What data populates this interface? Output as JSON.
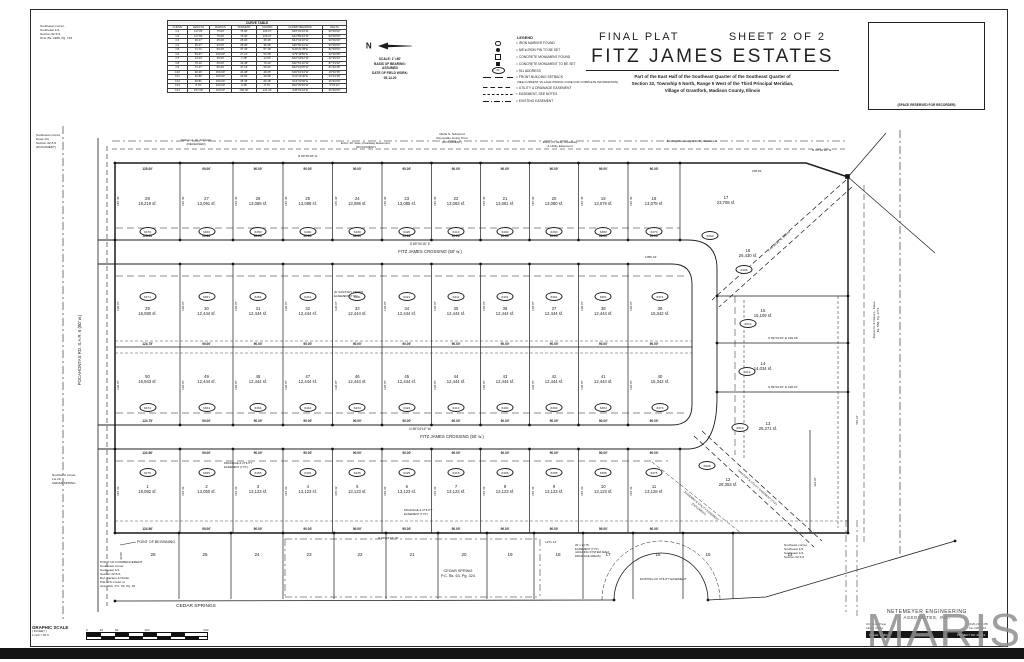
{
  "sheet": {
    "final_plat": "FINAL PLAT",
    "sheet_no": "SHEET 2 OF 2",
    "title": "FITZ JAMES ESTATES",
    "description": [
      "Part of the East Half of the Southeast Quarter of the Southeast Quarter of",
      "Section 32, Township 5 North, Range 5 West of the Third Principal Meridian,",
      "Village of Grantfork, Madison County, Illinois"
    ],
    "recorder_box": "(SPACE RESERVED FOR RECORDER)"
  },
  "north_block": {
    "north": "N",
    "lines": [
      "SCALE: 1\"=60'",
      "BASIS OF BEARING:",
      "ASSUMED",
      "DATE OF FIELD WORK:",
      "05-14-20"
    ]
  },
  "curve_table": {
    "title": "CURVE TABLE",
    "columns": [
      "CURVE",
      "LENGTH",
      "RADIUS",
      "TANGENT",
      "CHORD",
      "CHORD BEARING",
      "DELTA"
    ],
    "rows": [
      [
        "C1",
        "117.81'",
        "75.00'",
        "75.00'",
        "106.07'",
        "N45°04'16\"W",
        "90°00'00\""
      ],
      [
        "C2",
        "117.81'",
        "75.00'",
        "75.00'",
        "106.07'",
        "S44°55'44\"W",
        "90°00'00\""
      ],
      [
        "C3",
        "39.27'",
        "25.00'",
        "25.00'",
        "35.36'",
        "N44°04'16\"W",
        "90°00'00\""
      ],
      [
        "C4",
        "39.27'",
        "25.00'",
        "25.00'",
        "35.36'",
        "S45°55'44\"W",
        "90°00'00\""
      ],
      [
        "C5",
        "71.71'",
        "50.00'",
        "37.43'",
        "67.18'",
        "N40°21'35\"E",
        "82°09'54\""
      ],
      [
        "C6",
        "53.67'",
        "150.00'",
        "27.21'",
        "53.38'",
        "S79°48'50\"E",
        "20°30'08\""
      ],
      [
        "C7",
        "14.23'",
        "25.00'",
        "7.28'",
        "14.04'",
        "N16°34'52\"W",
        "32°36'24\""
      ],
      [
        "C8",
        "76.12'",
        "50.00'",
        "44.38'",
        "70.42'",
        "S02°51'10\"W",
        "87°13'32\""
      ],
      [
        "C9",
        "71.27'",
        "50.00'",
        "37.13'",
        "66.93'",
        "N42°10'05\"W",
        "81°40'28\""
      ],
      [
        "C10",
        "48.46'",
        "150.00'",
        "24.48'",
        "48.25'",
        "S09°16'44\"W",
        "18°30'35\""
      ],
      [
        "C11",
        "40.86'",
        "100.00'",
        "20.82'",
        "40.58'",
        "N11°44'40\"E",
        "23°24'48\""
      ],
      [
        "C12",
        "69.81'",
        "150.00'",
        "35.45'",
        "69.18'",
        "S13°20'00\"E",
        "26°40'00\""
      ],
      [
        "C13",
        "8.76'",
        "100.00'",
        "4.38'",
        "8.76'",
        "N02°30'36\"W",
        "5°01'12\""
      ],
      [
        "C14",
        "157.08'",
        "100.00'",
        "100.00'",
        "141.42'",
        "S45°04'16\"E",
        "90°00'00\""
      ]
    ]
  },
  "legend": {
    "title": "LEGEND",
    "items": [
      {
        "sym": "circle-open",
        "label": "= IRON MARKER FOUND"
      },
      {
        "sym": "circle-filled",
        "label": "= 5/8\"ø IRON PIN TO BE SET"
      },
      {
        "sym": "square-open",
        "label": "= CONCRETE MONUMENT FOUND"
      },
      {
        "sym": "square-filled",
        "label": "= CONCRETE MONUMENT TO BE SET"
      },
      {
        "sym": "oval",
        "label": "= 911 ADDRESS"
      },
      {
        "sym": "line-longdash",
        "label": "= FRONT BUILDING SETBACK"
      },
      {
        "sym": "note",
        "label": "(SEE CURRENT VILLAGE ZONING CODE FOR COMPLETE INFORMATION)"
      },
      {
        "sym": "line-dash",
        "label": "= UTILITY & DRAINAGE EASEMENT"
      },
      {
        "sym": "line-shortdash",
        "label": "= EASEMENT, SEE NOTES"
      },
      {
        "sym": "line-dashdot",
        "label": "= EXISTING EASEMENT"
      }
    ]
  },
  "plat": {
    "streets": {
      "fitz_james_1": "FITZ JAMES CROSSING (50' w.)",
      "fitz_james_2": "FITZ JAMES CROSSING (50' w.)",
      "pocahontas": "POCAHONTAS RD.   S.A.R. 6   (80' w.)",
      "cedar_springs": "CEDAR SPRINGS",
      "cedar_spring_plat": [
        "CEDAR SPRING",
        "P.C. Bk. 63, Pg. 324"
      ]
    },
    "rows": {
      "top": [
        {
          "num": "28",
          "area": "18,219 sf.",
          "addr": "6470"
        },
        {
          "num": "27",
          "area": "13,091 sf.",
          "addr": "6460"
        },
        {
          "num": "26",
          "area": "13,089 sf.",
          "addr": "6450"
        },
        {
          "num": "25",
          "area": "13,088 sf.",
          "addr": "6440"
        },
        {
          "num": "24",
          "area": "13,086 sf.",
          "addr": "6430"
        },
        {
          "num": "23",
          "area": "13,085 sf.",
          "addr": "6420"
        },
        {
          "num": "22",
          "area": "13,083 sf.",
          "addr": "6410"
        },
        {
          "num": "21",
          "area": "13,081 sf.",
          "addr": "6400"
        },
        {
          "num": "20",
          "area": "13,080 sf.",
          "addr": "6390"
        },
        {
          "num": "19",
          "area": "13,079 sf.",
          "addr": "6380"
        },
        {
          "num": "18",
          "area": "13,078 sf.",
          "addr": "6370"
        }
      ],
      "mid_upper": [
        {
          "num": "29",
          "area": "16,080 sf.",
          "addr": "6471"
        },
        {
          "num": "30",
          "area": "12,444 sf.",
          "addr": "6461"
        },
        {
          "num": "31",
          "area": "12,444 sf.",
          "addr": "6451"
        },
        {
          "num": "32",
          "area": "12,444 sf.",
          "addr": "6441"
        },
        {
          "num": "33",
          "area": "12,444 sf.",
          "addr": "6431"
        },
        {
          "num": "34",
          "area": "12,444 sf.",
          "addr": "6421"
        },
        {
          "num": "35",
          "area": "12,444 sf.",
          "addr": "6411"
        },
        {
          "num": "36",
          "area": "12,444 sf.",
          "addr": "6401"
        },
        {
          "num": "37",
          "area": "12,444 sf.",
          "addr": "6391"
        },
        {
          "num": "38",
          "area": "12,444 sf.",
          "addr": "6381"
        },
        {
          "num": "39",
          "area": "15,342 sf.",
          "addr": "6371"
        }
      ],
      "mid_lower": [
        {
          "num": "50",
          "area": "16,943 sf.",
          "addr": "6474"
        },
        {
          "num": "49",
          "area": "12,444 sf.",
          "addr": "6464"
        },
        {
          "num": "48",
          "area": "12,444 sf.",
          "addr": "6454"
        },
        {
          "num": "47",
          "area": "12,444 sf.",
          "addr": "6444"
        },
        {
          "num": "46",
          "area": "12,444 sf.",
          "addr": "6434"
        },
        {
          "num": "45",
          "area": "12,444 sf.",
          "addr": "6424"
        },
        {
          "num": "44",
          "area": "12,444 sf.",
          "addr": "6414"
        },
        {
          "num": "43",
          "area": "12,444 sf.",
          "addr": "6404"
        },
        {
          "num": "42",
          "area": "12,444 sf.",
          "addr": "6394"
        },
        {
          "num": "41",
          "area": "12,444 sf.",
          "addr": "6384"
        },
        {
          "num": "40",
          "area": "15,342 sf.",
          "addr": "6374"
        }
      ],
      "bottom": [
        {
          "num": "1",
          "area": "18,082 sf.",
          "addr": "6475"
        },
        {
          "num": "2",
          "area": "13,050 sf.",
          "addr": "6465"
        },
        {
          "num": "3",
          "area": "13,123 sf.",
          "addr": "6455"
        },
        {
          "num": "4",
          "area": "13,123 sf.",
          "addr": "6445"
        },
        {
          "num": "5",
          "area": "13,123 sf.",
          "addr": "6435"
        },
        {
          "num": "6",
          "area": "13,123 sf.",
          "addr": "6425"
        },
        {
          "num": "7",
          "area": "13,123 sf.",
          "addr": "6415"
        },
        {
          "num": "8",
          "area": "13,123 sf.",
          "addr": "6405"
        },
        {
          "num": "9",
          "area": "13,123 sf.",
          "addr": "6395"
        },
        {
          "num": "10",
          "area": "13,123 sf.",
          "addr": "6385"
        },
        {
          "num": "11",
          "area": "13,128 sf.",
          "addr": "6375"
        }
      ],
      "east": [
        {
          "num": "17",
          "area": "23,708 sf.",
          "addr": "6360"
        },
        {
          "num": "16",
          "area": "26,430 sf.",
          "addr": "6406"
        },
        {
          "num": "15",
          "area": "15,109 sf.",
          "addr": "6614"
        },
        {
          "num": "14",
          "area": "14,034 sf.",
          "addr": "6612"
        },
        {
          "num": "13",
          "area": "25,271 sf.",
          "addr": "6610"
        },
        {
          "num": "12",
          "area": "28,353 sf.",
          "addr": "6608"
        }
      ],
      "south_strip": [
        "26",
        "25",
        "24",
        "23",
        "22",
        "21",
        "20",
        "19",
        "18",
        "17",
        "16",
        "15",
        "14"
      ]
    },
    "dims": [
      {
        "y": 167,
        "labels": [
          "125.00'",
          "90.00'",
          "90.00'",
          "90.00'",
          "90.00'",
          "90.00'",
          "90.00'",
          "90.00'",
          "90.00'",
          "90.00'",
          "90.00'"
        ]
      },
      {
        "y": 234,
        "labels": [
          "125.00'",
          "90.00'",
          "90.00'",
          "90.00'",
          "90.00'",
          "90.00'",
          "90.00'",
          "90.00'",
          "90.00'",
          "90.00'",
          "90.00'"
        ]
      },
      {
        "y": 342,
        "labels": [
          "124.75'",
          "90.00'",
          "90.00'",
          "90.00'",
          "90.00'",
          "90.00'",
          "90.00'",
          "90.00'",
          "90.00'",
          "90.00'",
          "90.00'"
        ]
      },
      {
        "y": 419,
        "labels": [
          "124.75'",
          "90.00'",
          "90.00'",
          "90.00'",
          "90.00'",
          "90.00'",
          "90.00'",
          "90.00'",
          "90.00'",
          "90.00'",
          "90.00'"
        ]
      },
      {
        "y": 451,
        "labels": [
          "124.96'",
          "90.00'",
          "90.00'",
          "90.00'",
          "90.00'",
          "90.00'",
          "90.00'",
          "90.00'",
          "90.00'",
          "90.00'",
          "90.00'"
        ]
      },
      {
        "y": 527,
        "labels": [
          "124.96'",
          "90.00'",
          "90.00'",
          "90.00'",
          "90.00'",
          "90.00'",
          "90.00'",
          "90.00'",
          "90.00'",
          "90.00'",
          "90.00'"
        ]
      }
    ],
    "side_dims": {
      "top": "145.40'",
      "mid_upper": "138.07'",
      "mid_lower": "138.07'",
      "bottom": "145.43'"
    },
    "annotations": [
      {
        "x": 40,
        "y": 24,
        "fs": 3.1,
        "lines": [
          "Southwest corner,",
          "Southeast 1/4,",
          "Section 32-5-5,",
          "W.R. Bk. 2486, Pg. 743"
        ]
      },
      {
        "x": 36,
        "y": 133,
        "fs": 3.1,
        "lines": [
          "Southwest corner,",
          "Deed 1/4,",
          "Section 32-5-5",
          "(DOCUMENT)"
        ]
      },
      {
        "x": 52,
        "y": 473,
        "fs": 3.1,
        "lines": [
          "Northwest corner,",
          "Lot 26,",
          "CEDAR SPRING"
        ]
      },
      {
        "x": 137,
        "y": 540,
        "fs": 3.6,
        "lines": [
          "POINT OF BEGINNING"
        ]
      },
      {
        "x": 100,
        "y": 560,
        "fs": 3.1,
        "lines": [
          "POINT OF COMMENCEMENT",
          "Southeast corner,",
          "Southeast 1/4,",
          "Section 32-5-5,",
          "Ref. Backes & Pfeifer",
          "Plat of D-J Add. to",
          "Grantfork, P.C. 52, Pg. 46"
        ]
      },
      {
        "x": 784,
        "y": 543,
        "fs": 3.1,
        "lines": [
          "Northeast corner,",
          "Southeast 1/4,",
          "Southeast 1/4,",
          "Section 32-5-5"
        ]
      },
      {
        "x": 196,
        "y": 138,
        "fs": 3.1,
        "al": "c",
        "lines": [
          "Nathan A. W. Schwarz",
          "(DECEASED)"
        ]
      },
      {
        "x": 366,
        "y": 141,
        "fs": 3.1,
        "al": "c",
        "lines": [
          "Exist. 20' wide, Roadway Easement,",
          "(DOCUMENT)"
        ]
      },
      {
        "x": 452,
        "y": 132,
        "fs": 3.1,
        "al": "c",
        "lines": [
          "Marla S. Schwend",
          "Revocable Living Trust",
          "(DOCUMENT)"
        ]
      },
      {
        "x": 560,
        "y": 140,
        "fs": 3.1,
        "al": "c",
        "lines": [
          "Exist. 20' wide, Roadway",
          "& Utility Easement"
        ]
      },
      {
        "x": 692,
        "y": 139,
        "fs": 3.1,
        "al": "c",
        "lines": [
          "Existing Roadway & Utility Easement"
        ]
      },
      {
        "x": 812,
        "y": 148,
        "fs": 3.1,
        "lines": [
          "N 00°40'26\" E"
        ]
      },
      {
        "x": 876,
        "y": 320,
        "fs": 3.1,
        "rot": -90,
        "al": "c",
        "lines": [
          "James R. & Diane L. Klaus",
          "Bk. 558, Pg. 1774"
        ]
      },
      {
        "x": 420,
        "y": 242,
        "fs": 3.3,
        "al": "c",
        "lines": [
          "S 89°04'16\" E"
        ]
      },
      {
        "x": 645,
        "y": 255,
        "fs": 3.1,
        "lines": [
          "1055.34'"
        ]
      },
      {
        "x": 420,
        "y": 427,
        "fs": 3.3,
        "al": "c",
        "lines": [
          "N 89°04'16\" W"
        ]
      },
      {
        "x": 298,
        "y": 154,
        "fs": 3.1,
        "lines": [
          "N 89°40'26\" E"
        ]
      },
      {
        "x": 752,
        "y": 169,
        "fs": 3.1,
        "lines": [
          "236.81'"
        ]
      },
      {
        "x": 779,
        "y": 241,
        "fs": 3.1,
        "rot": -42,
        "al": "c",
        "lines": [
          "S 46°23'51\" E   340.44'"
        ]
      },
      {
        "x": 783,
        "y": 336,
        "fs": 3.1,
        "al": "c",
        "lines": [
          "S 89°04'16\" E   199.96'"
        ]
      },
      {
        "x": 783,
        "y": 385,
        "fs": 3.1,
        "al": "c",
        "lines": [
          "S 89°04'16\" E   196.97'"
        ]
      },
      {
        "x": 378,
        "y": 536,
        "fs": 3.1,
        "lines": [
          "N 89°04'16\" W"
        ]
      },
      {
        "x": 545,
        "y": 540,
        "fs": 3.1,
        "lines": [
          "1271.14'"
        ]
      },
      {
        "x": 575,
        "y": 544,
        "fs": 2.8,
        "lines": [
          "20' x 24.75'",
          "EASEMENT (TYP.)",
          "(HOLDING SYSTEM AREA",
          "DRAINAGE AREAS)"
        ]
      },
      {
        "x": 640,
        "y": 578,
        "fs": 2.9,
        "lines": [
          "EXISTING 20' UTILITY EASEMENT"
        ]
      },
      {
        "x": 757,
        "y": 488,
        "fs": 2.8,
        "rot": 42,
        "al": "c",
        "lines": [
          "SANITARY & UTILITY EASEMENT (TYP.)"
        ]
      },
      {
        "x": 404,
        "y": 509,
        "fs": 2.8,
        "lines": [
          "DRAINAGE & UTILITY",
          "EASEMENT (TYP.)"
        ]
      },
      {
        "x": 224,
        "y": 462,
        "fs": 2.8,
        "lines": [
          "DRAINAGE & UTILITY",
          "EASEMENT (TYP.)"
        ]
      },
      {
        "x": 334,
        "y": 291,
        "fs": 2.8,
        "lines": [
          "20' SANITARY SEWER",
          "EASEMENT (TYP.)"
        ]
      },
      {
        "x": 700,
        "y": 508,
        "fs": 2.8,
        "rot": 40,
        "al": "c",
        "lines": [
          "ROADWAY & UTILITY EASEMENT",
          "(DOCUMENT)"
        ]
      },
      {
        "x": 122,
        "y": 556,
        "fs": 2.9,
        "rot": -90,
        "al": "c",
        "lines": [
          "40.00'"
        ]
      },
      {
        "x": 858,
        "y": 420,
        "fs": 2.9,
        "rot": -90,
        "al": "c",
        "lines": [
          "682.24'"
        ]
      },
      {
        "x": 816,
        "y": 482,
        "fs": 2.9,
        "rot": -90,
        "al": "c",
        "lines": [
          "122.46'"
        ]
      }
    ]
  },
  "scale_bar": {
    "title": "GRAPHIC SCALE",
    "sub1": "( IN FEET )",
    "sub2": "1 inch = 60 ft.",
    "ticks": [
      "0",
      "30",
      "60",
      "120",
      "240"
    ]
  },
  "engineer": {
    "line1": "NETEMEYER ENGINEERING",
    "line2": "ASSOCIATES, INC.",
    "addr1": "101 South Page",
    "addr2": "Albers, Illinois",
    "tel1": "(618) 248-5155",
    "tel2": "Fax 248-5316",
    "bar_left": "SCALE: 1\"=60'",
    "bar_right": "PROJECT NO. 20-113"
  },
  "watermark": "MARIS"
}
